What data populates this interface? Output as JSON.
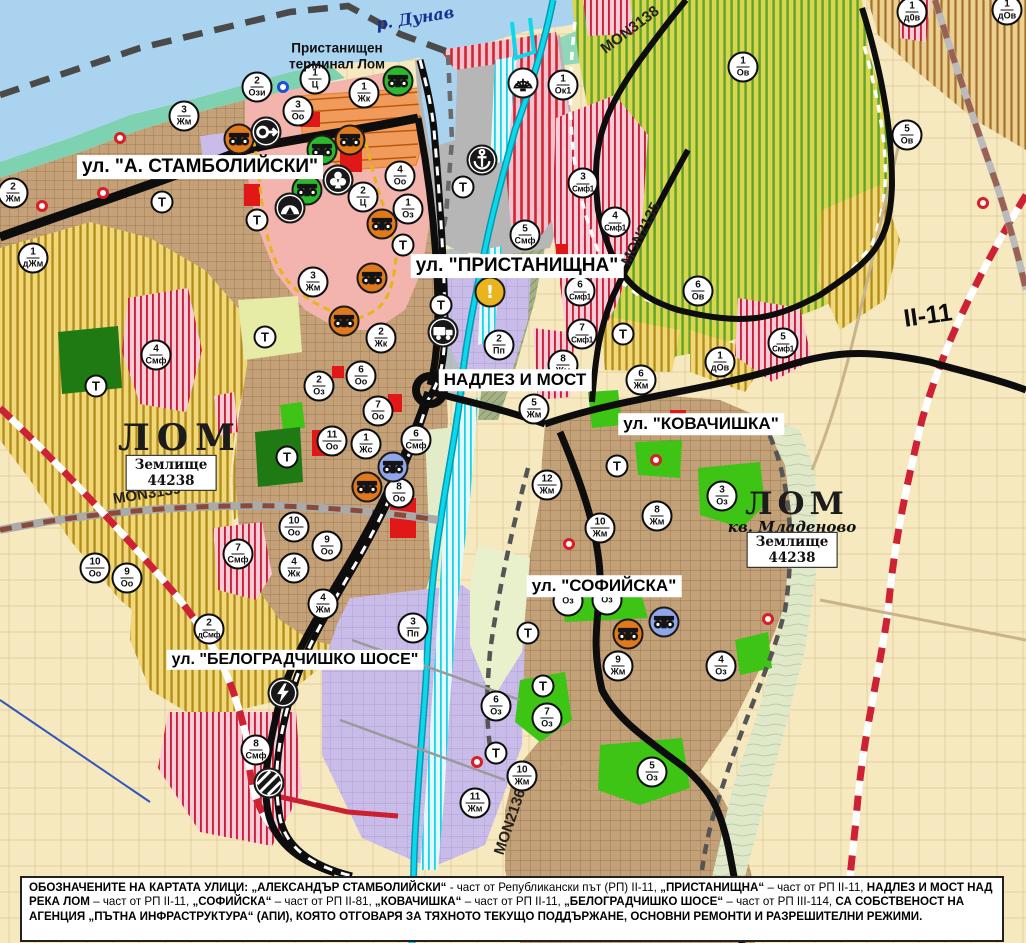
{
  "map_title": "Устройствен план на град Лом",
  "t_label": "Т",
  "river_label": "р. Дунав",
  "terminal_label": "Пристанищен\nтерминал Лом",
  "street_labels": [
    {
      "text": "ул. \"А. СТАМБОЛИЙСКИ\"",
      "x": 200,
      "y": 167,
      "fs": 19
    },
    {
      "text": "ул. \"ПРИСТАНИЩНА\"",
      "x": 517,
      "y": 266,
      "fs": 19
    },
    {
      "text": "НАДЛЕЗ И МОСТ",
      "x": 515,
      "y": 380,
      "fs": 17
    },
    {
      "text": "ул. \"КОВАЧИШКА\"",
      "x": 701,
      "y": 424,
      "fs": 17
    },
    {
      "text": "ул. \"СОФИЙСКА\"",
      "x": 604,
      "y": 586,
      "fs": 17
    },
    {
      "text": "ул. \"БЕЛОГРАДЧИШКО ШОСЕ\"",
      "x": 295,
      "y": 660,
      "fs": 16
    }
  ],
  "map_labels": [
    {
      "text": "р. Дунав",
      "x": 415,
      "y": 18,
      "cls": "river",
      "rot": -9
    },
    {
      "text": "Пристанищен\nтерминал Лом",
      "x": 337,
      "y": 56,
      "cls": "terminal",
      "rot": 0
    },
    {
      "text": "ЛОМ",
      "x": 180,
      "y": 438,
      "cls": "city",
      "rot": 0
    },
    {
      "text": "ЛОМ",
      "x": 797,
      "y": 504,
      "cls": "city2",
      "rot": 0
    },
    {
      "text": "кв. Младеново",
      "x": 792,
      "y": 527,
      "cls": "district",
      "rot": 0
    }
  ],
  "road_labels": [
    {
      "text": "MON3138",
      "x": 630,
      "y": 30,
      "rot": -37,
      "big": false
    },
    {
      "text": "MON2135",
      "x": 641,
      "y": 234,
      "rot": -63,
      "big": false
    },
    {
      "text": "MON3139",
      "x": 147,
      "y": 494,
      "rot": -9,
      "big": false
    },
    {
      "text": "MON2136",
      "x": 510,
      "y": 822,
      "rot": -71,
      "big": false
    },
    {
      "text": "II-11",
      "x": 928,
      "y": 316,
      "rot": -8,
      "big": true
    }
  ],
  "area_boxes": [
    {
      "line1": "Землище",
      "line2": "44238",
      "x": 171,
      "y": 473
    },
    {
      "line1": "Землище",
      "line2": "44238",
      "x": 792,
      "y": 550
    }
  ],
  "zone_markers": [
    {
      "n": "2",
      "z": "Ози",
      "x": 257,
      "y": 87
    },
    {
      "n": "1",
      "z": "Ц",
      "x": 315,
      "y": 79
    },
    {
      "n": "3",
      "z": "Оо",
      "x": 298,
      "y": 111
    },
    {
      "n": "1",
      "z": "Жк",
      "x": 364,
      "y": 93
    },
    {
      "n": "1",
      "z": "Ок1",
      "x": 563,
      "y": 85
    },
    {
      "n": "3",
      "z": "Жм",
      "x": 184,
      "y": 116
    },
    {
      "n": "2",
      "z": "Жм",
      "x": 13,
      "y": 193
    },
    {
      "n": "1",
      "z": "дЖм",
      "x": 33,
      "y": 258
    },
    {
      "n": "4",
      "z": "Оо",
      "x": 400,
      "y": 176
    },
    {
      "n": "2",
      "z": "Ц",
      "x": 363,
      "y": 197
    },
    {
      "n": "1",
      "z": "Оз",
      "x": 408,
      "y": 209
    },
    {
      "n": "3",
      "z": "Жм",
      "x": 313,
      "y": 282
    },
    {
      "n": "3",
      "z": "Смф1",
      "x": 583,
      "y": 183
    },
    {
      "n": "5",
      "z": "Смф",
      "x": 525,
      "y": 235
    },
    {
      "n": "4",
      "z": "Смф1",
      "x": 615,
      "y": 222
    },
    {
      "n": "6",
      "z": "Смф1",
      "x": 580,
      "y": 291
    },
    {
      "n": "7",
      "z": "Смф1",
      "x": 582,
      "y": 334
    },
    {
      "n": "2",
      "z": "Жк",
      "x": 381,
      "y": 338
    },
    {
      "n": "2",
      "z": "Пп",
      "x": 499,
      "y": 345
    },
    {
      "n": "4",
      "z": "Смф",
      "x": 156,
      "y": 355
    },
    {
      "n": "2",
      "z": "Оз",
      "x": 319,
      "y": 386
    },
    {
      "n": "6",
      "z": "Оо",
      "x": 361,
      "y": 376
    },
    {
      "n": "7",
      "z": "Оо",
      "x": 378,
      "y": 411
    },
    {
      "n": "11",
      "z": "Оо",
      "x": 332,
      "y": 441
    },
    {
      "n": "1",
      "z": "Жс",
      "x": 366,
      "y": 444
    },
    {
      "n": "6",
      "z": "Смф",
      "x": 416,
      "y": 440
    },
    {
      "n": "8",
      "z": "Оо",
      "x": 399,
      "y": 493
    },
    {
      "n": "8",
      "z": "Жм",
      "x": 563,
      "y": 365
    },
    {
      "n": "5",
      "z": "Жм",
      "x": 534,
      "y": 409
    },
    {
      "n": "6",
      "z": "Жм",
      "x": 641,
      "y": 380
    },
    {
      "n": "12",
      "z": "Жм",
      "x": 547,
      "y": 485
    },
    {
      "n": "10",
      "z": "Жм",
      "x": 600,
      "y": 528
    },
    {
      "n": "8",
      "z": "Жм",
      "x": 657,
      "y": 516
    },
    {
      "n": "3",
      "z": "Оз",
      "x": 722,
      "y": 496
    },
    {
      "n": "10",
      "z": "Жм",
      "x": 522,
      "y": 776
    },
    {
      "n": "11",
      "z": "Жм",
      "x": 475,
      "y": 803
    },
    {
      "n": "5",
      "z": "Оз",
      "x": 652,
      "y": 772
    },
    {
      "n": "6",
      "z": "Оз",
      "x": 496,
      "y": 706
    },
    {
      "n": "7",
      "z": "Оз",
      "x": 547,
      "y": 718
    },
    {
      "n": "9",
      "z": "Жм",
      "x": 618,
      "y": 666
    },
    {
      "n": "4",
      "z": "Оз",
      "x": 721,
      "y": 666
    },
    {
      "n": "",
      "z": "Оз",
      "x": 568,
      "y": 601
    },
    {
      "n": "",
      "z": "Оз",
      "x": 607,
      "y": 600
    },
    {
      "n": "10",
      "z": "Оо",
      "x": 294,
      "y": 527
    },
    {
      "n": "9",
      "z": "Оо",
      "x": 327,
      "y": 546
    },
    {
      "n": "4",
      "z": "Жк",
      "x": 294,
      "y": 568
    },
    {
      "n": "7",
      "z": "Смф",
      "x": 238,
      "y": 554
    },
    {
      "n": "2",
      "z": "дСмф",
      "x": 209,
      "y": 629
    },
    {
      "n": "4",
      "z": "Жм",
      "x": 323,
      "y": 604
    },
    {
      "n": "3",
      "z": "Пп",
      "x": 413,
      "y": 628
    },
    {
      "n": "8",
      "z": "Смф",
      "x": 256,
      "y": 750
    },
    {
      "n": "1",
      "z": "Ов",
      "x": 743,
      "y": 67
    },
    {
      "n": "5",
      "z": "Ов",
      "x": 907,
      "y": 135
    },
    {
      "n": "1",
      "z": "д0в",
      "x": 912,
      "y": 12
    },
    {
      "n": "1",
      "z": "дОв",
      "x": 1007,
      "y": 10
    },
    {
      "n": "6",
      "z": "Ов",
      "x": 698,
      "y": 291
    },
    {
      "n": "5",
      "z": "Смф1",
      "x": 783,
      "y": 343
    },
    {
      "n": "1",
      "z": "дОв",
      "x": 720,
      "y": 362
    },
    {
      "n": "10",
      "z": "Оо",
      "x": 95,
      "y": 568
    },
    {
      "n": "9",
      "z": "Оо",
      "x": 127,
      "y": 578
    }
  ],
  "t_markers": [
    {
      "x": 162,
      "y": 202
    },
    {
      "x": 257,
      "y": 220
    },
    {
      "x": 265,
      "y": 337
    },
    {
      "x": 403,
      "y": 245
    },
    {
      "x": 441,
      "y": 305
    },
    {
      "x": 463,
      "y": 187
    },
    {
      "x": 96,
      "y": 386
    },
    {
      "x": 287,
      "y": 457
    },
    {
      "x": 623,
      "y": 334
    },
    {
      "x": 617,
      "y": 466
    },
    {
      "x": 528,
      "y": 633
    },
    {
      "x": 543,
      "y": 686
    },
    {
      "x": 496,
      "y": 753
    }
  ],
  "icon_markers": [
    {
      "icon": "monument-icon",
      "variant": "orange",
      "x": 239,
      "y": 139
    },
    {
      "icon": "monument-icon",
      "variant": "orange",
      "x": 350,
      "y": 140
    },
    {
      "icon": "monument-icon",
      "variant": "orange",
      "x": 382,
      "y": 224
    },
    {
      "icon": "monument-icon",
      "variant": "orange",
      "x": 372,
      "y": 278
    },
    {
      "icon": "monument-icon",
      "variant": "orange",
      "x": 344,
      "y": 321
    },
    {
      "icon": "monument-icon",
      "variant": "orange",
      "x": 367,
      "y": 487
    },
    {
      "icon": "monument-icon",
      "variant": "orange",
      "x": 628,
      "y": 634
    },
    {
      "icon": "monument-icon",
      "variant": "green",
      "x": 398,
      "y": 81
    },
    {
      "icon": "monument-icon",
      "variant": "green",
      "x": 322,
      "y": 150
    },
    {
      "icon": "monument-icon",
      "variant": "green",
      "x": 307,
      "y": 190
    },
    {
      "icon": "monument-icon",
      "variant": "blue",
      "x": 393,
      "y": 467
    },
    {
      "icon": "monument-icon",
      "variant": "blue",
      "x": 664,
      "y": 622
    },
    {
      "icon": "sight-arrow-icon",
      "variant": "black",
      "x": 266,
      "y": 132
    },
    {
      "icon": "club-icon",
      "variant": "black",
      "x": 338,
      "y": 180
    },
    {
      "icon": "cave-icon",
      "variant": "black",
      "x": 290,
      "y": 208
    },
    {
      "icon": "anchor-icon",
      "variant": "black",
      "x": 482,
      "y": 160
    },
    {
      "icon": "fan-icon",
      "variant": "white",
      "x": 523,
      "y": 83
    },
    {
      "icon": "warning-icon",
      "variant": "amber",
      "x": 490,
      "y": 292
    },
    {
      "icon": "truck-icon",
      "variant": "black",
      "x": 443,
      "y": 332
    },
    {
      "icon": "lightning-icon",
      "variant": "black",
      "x": 283,
      "y": 693
    },
    {
      "icon": "rail-crossing-icon",
      "variant": "black",
      "x": 269,
      "y": 783
    }
  ],
  "dot_markers": [
    {
      "color": "blue",
      "x": 283,
      "y": 87
    },
    {
      "color": "red",
      "x": 120,
      "y": 138
    },
    {
      "color": "red",
      "x": 103,
      "y": 193
    },
    {
      "color": "red",
      "x": 42,
      "y": 206
    },
    {
      "color": "red",
      "x": 656,
      "y": 460
    },
    {
      "color": "red",
      "x": 983,
      "y": 203
    },
    {
      "color": "red",
      "x": 569,
      "y": 544
    },
    {
      "color": "red",
      "x": 768,
      "y": 619
    },
    {
      "color": "red",
      "x": 477,
      "y": 762
    }
  ],
  "footer": {
    "segments": [
      {
        "t": "ОБОЗНАЧЕНИТЕ НА КАРТАТА УЛИЦИ: „АЛЕКСАНДЪР СТАМБОЛИЙСКИ“",
        "b": true
      },
      {
        "t": " - част от Републикански път (РП) II-11, ",
        "b": false
      },
      {
        "t": "„ПРИСТАНИЩНА“",
        "b": true
      },
      {
        "t": " – част от РП II-11, ",
        "b": false
      },
      {
        "t": "НАДЛЕЗ И МОСТ НАД РЕКА ЛОМ",
        "b": true
      },
      {
        "t": " – част от РП II-11, ",
        "b": false
      },
      {
        "t": "„СОФИЙСКА“",
        "b": true
      },
      {
        "t": " – част от РП II-81, ",
        "b": false
      },
      {
        "t": "„КОВАЧИШКА“",
        "b": true
      },
      {
        "t": " – част от РП II-11, ",
        "b": false
      },
      {
        "t": "„БЕЛОГРАДЧИШКО ШОСЕ“",
        "b": true
      },
      {
        "t": " – част от РП III-114, ",
        "b": false
      },
      {
        "t": "СА СОБСТВЕНОСТ НА АГЕНЦИЯ „ПЪТНА ИНФРАСТРУКТУРА“ (АПИ), КОЯТО ОТГОВАРЯ ЗА ТЯХНОТО ТЕКУЩО ПОДДЪРЖАНЕ, ОСНОВНИ РЕМОНТИ И РАЗРЕШИТЕЛНИ РЕЖИМИ.",
        "b": true
      }
    ]
  },
  "colors": {
    "water": "#a9d3ef",
    "shore": "#7ed2b2",
    "urban": "#c4a178",
    "center_pink": "#f2b4ac",
    "purple_zone": "#cabce8",
    "park_green": "#3ec414",
    "dark_green": "#1f7a14",
    "field_yellow": "#f6e9c0",
    "stripe_gold": "#b08a1a",
    "stripe_green": "#5da32c",
    "stripe_red": "#c9203a",
    "river_cyan": "#0cd8ec",
    "road_black": "#0d0d0d",
    "road_red_dash": "#cc2233"
  }
}
